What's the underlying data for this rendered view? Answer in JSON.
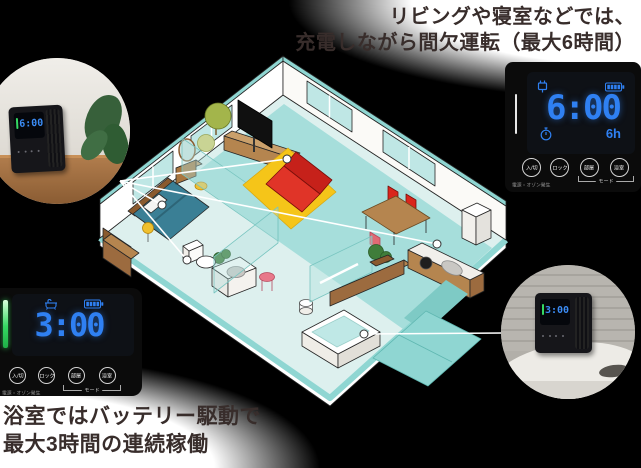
{
  "captions": {
    "living": {
      "line1": "リビングや寝室などでは、",
      "line2": "充電しながら間欠運転（最大6時間）"
    },
    "bath": {
      "line1": "浴室ではバッテリー駆動で",
      "line2": "最大3時間の連続稼働"
    }
  },
  "panel_living": {
    "time": "6:00",
    "duration": "6h",
    "buttons": {
      "power": "入/切",
      "lock": "ロック",
      "mode_room": "部屋",
      "mode_bath": "浴室"
    },
    "power_caption": "電源・オゾン発生",
    "mode_caption": "モード",
    "status_icons": [
      "plug-icon",
      "battery-icon",
      "timer-icon"
    ],
    "led_state": "off"
  },
  "panel_bath": {
    "time": "3:00",
    "buttons": {
      "power": "入/切",
      "lock": "ロック",
      "mode_room": "部屋",
      "mode_bath": "浴室"
    },
    "power_caption": "電源・オゾン発生",
    "mode_caption": "モード",
    "status_icons": [
      "bath-icon",
      "battery-icon"
    ],
    "led_state": "green"
  },
  "photos": {
    "living": {
      "display_time": "6:00"
    },
    "bath": {
      "display_time": "3:00"
    }
  },
  "colors": {
    "background": "#000000",
    "display_blue": "#2f80f2",
    "led_green": "#35d963",
    "room_teal": "#8fd6d2",
    "sofa_red": "#d9261c",
    "rug_yellow": "#f5c519",
    "wood_brown": "#b5854f",
    "caption_text": "#382d2b"
  },
  "callouts": {
    "origin": {
      "x": 120,
      "y": 181
    },
    "placements": [
      {
        "name": "tv-board",
        "x": 287,
        "y": 159
      },
      {
        "name": "bedroom",
        "x": 162,
        "y": 205
      },
      {
        "name": "toilet",
        "x": 187,
        "y": 260
      },
      {
        "name": "kitchen",
        "x": 437,
        "y": 244
      }
    ],
    "bath_placement": {
      "name": "bathtub",
      "x": 364,
      "y": 334,
      "line_to_x": 503,
      "line_to_y": 333
    }
  }
}
